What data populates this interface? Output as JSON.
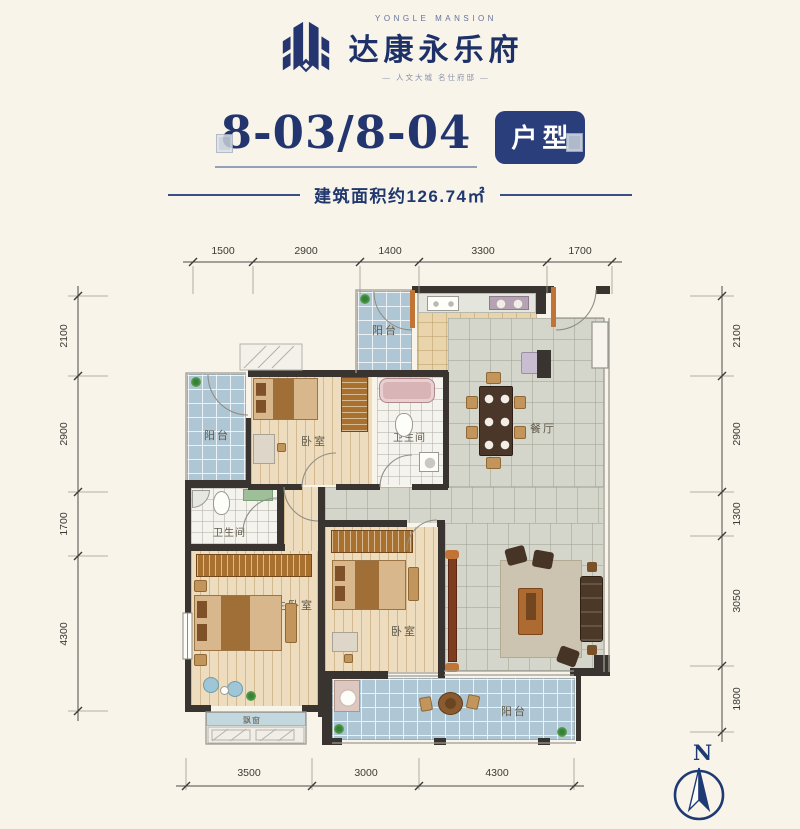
{
  "header": {
    "brand_en": "YONGLE MANSION",
    "brand_cn": "达康永乐府",
    "tagline": "— 人文大城  名仕府邸 —"
  },
  "title": {
    "unit_numbers": "8-03/8-04",
    "badge": "户型",
    "area_note": "建筑面积约126.74㎡"
  },
  "plan": {
    "rooms": {
      "balcony_top": "阳台",
      "kitchen": "厨房",
      "dining": "餐厅",
      "balcony_left": "阳台",
      "bedroom1": "卧室",
      "bath1": "卫生间",
      "bath2": "卫生间",
      "master_bedroom": "主卧室",
      "bay_window": "飘窗",
      "bedroom2": "卧室",
      "living": "客厅",
      "balcony_bottom": "阳台"
    }
  },
  "dims": {
    "top": [
      "1500",
      "2900",
      "1400",
      "3300",
      "1700"
    ],
    "left": [
      "2100",
      "2900",
      "1700",
      "4300"
    ],
    "right": [
      "2100",
      "2900",
      "1300",
      "3050",
      "1800"
    ],
    "bottom": [
      "3500",
      "3000",
      "4300"
    ]
  },
  "compass": {
    "north_label": "N"
  },
  "colors": {
    "navy": "#23356e",
    "wall": "#3a3430",
    "balcony_tile": "#afc7d4",
    "floor_tile": "#d4d6cb",
    "wood_floor": "#eddcbd",
    "accent_orange": "#c07536"
  }
}
